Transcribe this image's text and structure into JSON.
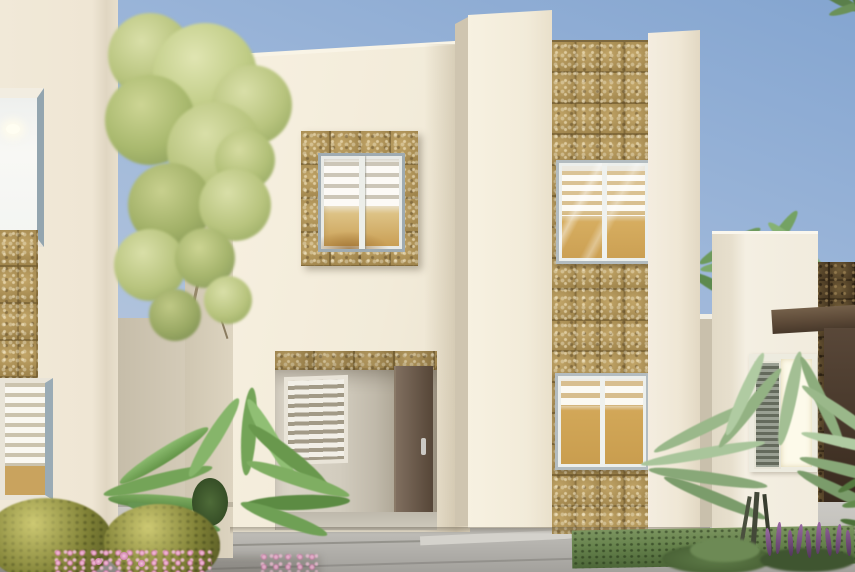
{
  "scene": {
    "title": "Residential exterior rendering",
    "description": "Daytime 3D architectural rendering of a two-story beige stucco house with travertine stone tile accents, a recessed entry with brown door, windows with white horizontal blinds, flanked by neighboring houses, palm trees, shrubs and flowers under a clear blue sky",
    "setting": "sunny day, clear sky"
  },
  "colors": {
    "sky_top": "#84a5d0",
    "sky_bottom": "#c4cfe0",
    "stucco_light": "#f2ebd9",
    "stucco_shadow": "#d6cdba",
    "stone_tile": "#a98f58",
    "stone_grout": "#6f5a35",
    "dark_stone": "#57452c",
    "window_frame_white": "#ebe9e1",
    "window_frame_gray": "#9aacb6",
    "glass_amber": "#d0a458",
    "blind_white": "#f6f3ec",
    "entry_door_brown": "#6b5745",
    "dark_wood_brown": "#4b3828",
    "roof_beam_brown": "#5d4a38",
    "pavement_gray": "#c3c1bc",
    "grass_green": "#6f8b54",
    "shrub_olive": "#8a8a3e",
    "palm_green": "#7fae62",
    "fern_green": "#93af83",
    "tree_foliage": "#b8c47e",
    "flower_pink": "#e7a6c9",
    "flower_purple": "#744f80",
    "coping_white": "#f3f0e7",
    "bright_door_panel": "#fdfaea"
  },
  "buildings": {
    "left_neighbor": {
      "stories": 2,
      "visible_elements": [
        "lit upper window with ceiling lamp",
        "stone tile wall panel",
        "window with striped blinds"
      ]
    },
    "main_house": {
      "stories": 2,
      "visible_elements": [
        "flat parapet roofline",
        "stone-framed upper window with blinds",
        "recessed entry porch",
        "stone tile lintel band",
        "louvered entry window",
        "brown entry door with handle",
        "stone tile accent column",
        "two stacked tower windows with blinds",
        "flanking stucco pilasters"
      ]
    },
    "right_neighbor": {
      "stories": 1,
      "visible_elements": [
        "white parapet wall",
        "dark stone accent wall",
        "brown roof beam",
        "glazed white entry door with louver panel",
        "dark wood gate"
      ]
    }
  },
  "landscaping": [
    "yellow-green tree between houses",
    "cycad palm by entry walk",
    "two olive-green shrubs",
    "pink ground flowers",
    "areca fern palm at right",
    "purple flower spikes",
    "lawn strip",
    "background palm trees"
  ],
  "ground": [
    "concrete paver walkway",
    "expansion joints",
    "grass strip"
  ],
  "windows": {
    "style": "aluminum frames, white horizontal blinds, amber tinted glass",
    "count_visible": 7
  }
}
